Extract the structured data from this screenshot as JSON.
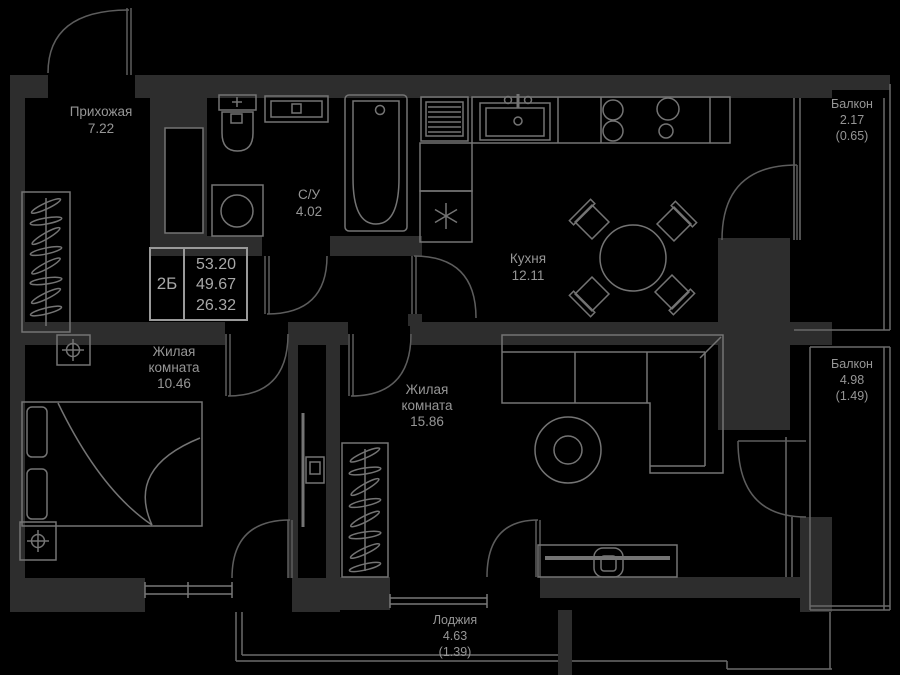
{
  "unit": {
    "type_label": "2Б",
    "areas": [
      "53.20",
      "49.67",
      "26.32"
    ]
  },
  "rooms": [
    {
      "name": "Прихожая",
      "area": "7.22"
    },
    {
      "name": "С/У",
      "area": "4.02"
    },
    {
      "name": "Кухня",
      "area": "12.11"
    },
    {
      "name": "Жилая комната",
      "area": "10.46"
    },
    {
      "name": "Жилая комната",
      "area": "15.86"
    }
  ],
  "outdoor": [
    {
      "name": "Балкон",
      "area": "2.17",
      "reduced_area": "(0.65)"
    },
    {
      "name": "Балкон",
      "area": "4.98",
      "reduced_area": "(1.49)"
    },
    {
      "name": "Лоджия",
      "area": "4.63",
      "reduced_area": "(1.39)"
    }
  ],
  "colors": {
    "background": "#000000",
    "wall": "#2d2d2d",
    "fixture_line": "#747474",
    "door_line": "#5d5d5d",
    "thin_line": "#6a6a6a",
    "text": "#969696",
    "info_text": "#a8a8a8"
  }
}
